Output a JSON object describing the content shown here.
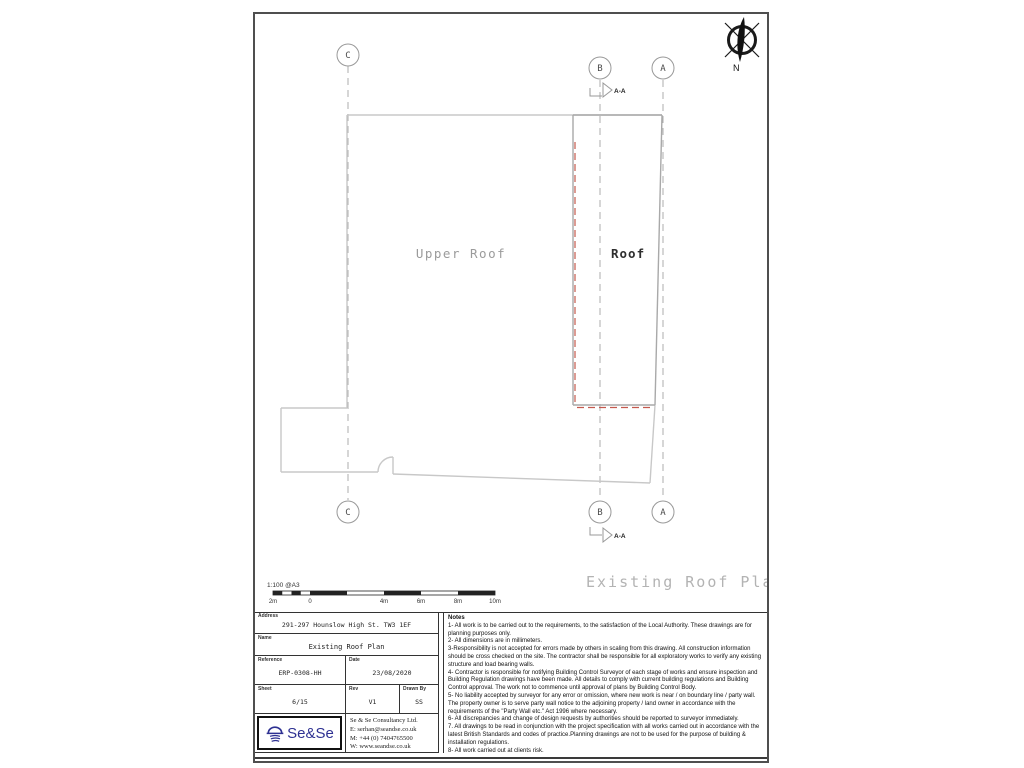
{
  "drawing": {
    "plan_title": "Existing Roof Plan",
    "upper_roof_label": "Upper Roof",
    "roof_label": "Roof",
    "grid_letters": {
      "c": "C",
      "b": "B",
      "a": "A"
    },
    "section_label": "A-A",
    "north_label": "N",
    "scale_label": "1:100 @A3",
    "scale_ticks": [
      "2m",
      "0",
      "4m",
      "6m",
      "8m",
      "10m"
    ]
  },
  "title_block": {
    "address_label": "Address",
    "address": "291-297 Hounslow High St. TW3 1EF",
    "name_label": "Name",
    "name": "Existing Roof Plan",
    "reference_label": "Reference",
    "reference": "ERP-0308-HH",
    "date_label": "Date",
    "date": "23/08/2020",
    "sheet_label": "Sheet",
    "sheet": "6/15",
    "rev_label": "Rev",
    "rev": "V1",
    "drawn_by_label": "Drawn By",
    "drawn_by": "SS",
    "logo_text": "Se&Se",
    "company": "Se & Se Consultancy Ltd.",
    "email": "E: serhan@seandse.co.uk",
    "mobile": "M: +44 (0) 7404765500",
    "web": "W: www.seandse.co.uk"
  },
  "notes": {
    "title": "Notes",
    "items": [
      "1- All work is to be carried out to the requirements, to the satisfaction of the Local Authority. These drawings are for planning purposes only.",
      "2- All dimensions are in millimeters.",
      "3-Responsibility is not accepted for errors made by others in scaling from this drawing.  All construction information should be cross checked on the site. The contractor shall be responsible for  all exploratory works to verify any existing structure and load bearing walls.",
      "4- Contractor is responsible for notifying Building Control Surveyor of each stage of works and ensure inspection and Building Regulation drawings have been made. All details to comply with current building regulations and Building Control approval. The work not to commence until approval of plans by Building Control Body.",
      "5- No liability accepted by surveyor for any error or omission, where new work is near / on boundary line / party wall. The property owner is to serve party wall notice to the adjoining property / land owner in accordance with the requirements of the \"Party Wall etc.\" Act 1996 where necessary.",
      "6- All discrepancies and change of design requests by authorities  should be reported to surveyor immediately.",
      "7. All drawings to be read in conjunction with the project specification with all works carried out in accordance with the latest British Standards and codes of practice.Planning drawings are not to be used for the purpose of building & installation regulations.",
      "8- All work carried out at clients risk."
    ]
  },
  "colors": {
    "wall_gray": "#c8c8c8",
    "roof_gray": "#a9a9a9",
    "marker_red": "#c4594e",
    "logo_blue": "#2e3192"
  }
}
